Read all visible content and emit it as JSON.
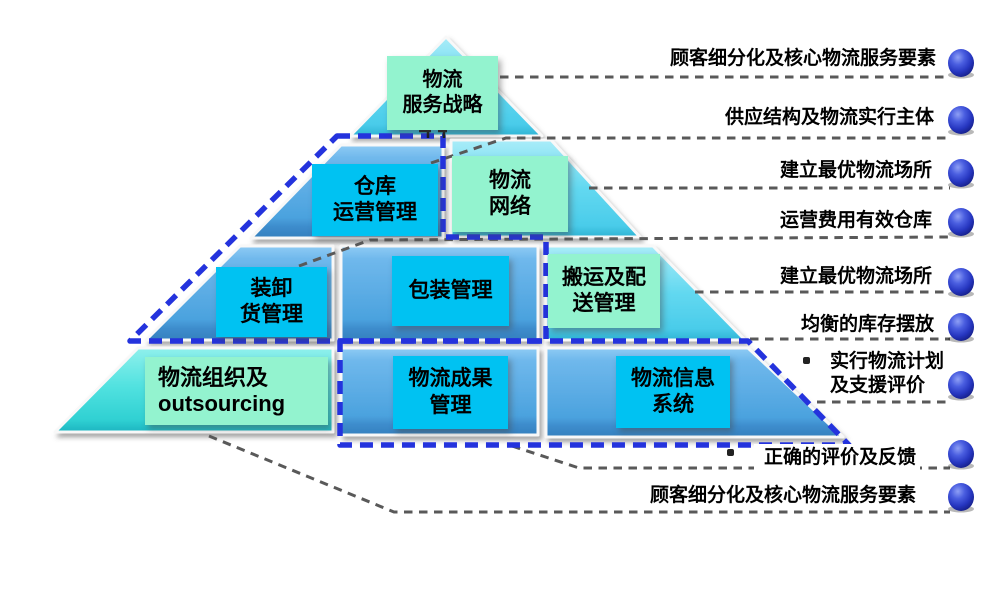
{
  "diagram": {
    "type": "pyramid",
    "subject": "logistics management hierarchy",
    "boxes": [
      {
        "id": "strategy",
        "text": "物流\n服务战略",
        "style": "mint"
      },
      {
        "id": "warehouse-ops",
        "text": "仓库\n运营管理",
        "style": "cyan"
      },
      {
        "id": "network",
        "text": "物流\n网络",
        "style": "mint"
      },
      {
        "id": "loading",
        "text": "装卸\n货管理",
        "style": "cyan"
      },
      {
        "id": "packaging",
        "text": "包装管理",
        "style": "cyan"
      },
      {
        "id": "handling-delivery",
        "text": "搬运及配\n送管理",
        "style": "mint"
      },
      {
        "id": "organization",
        "text": "物流组织及\noutsourcing",
        "style": "mint"
      },
      {
        "id": "results",
        "text": "物流成果\n管理",
        "style": "cyan"
      },
      {
        "id": "information",
        "text": "物流信息\n系统",
        "style": "cyan"
      }
    ],
    "annotations": [
      {
        "id": "a1",
        "text": "顾客细分化及核心物流服务要素",
        "bullet": false
      },
      {
        "id": "a2",
        "text": "供应结构及物流实行主体",
        "bullet": false
      },
      {
        "id": "a3",
        "text": "建立最优物流场所",
        "bullet": false
      },
      {
        "id": "a4",
        "text": "运营费用有效仓库",
        "bullet": false
      },
      {
        "id": "a5",
        "text": "建立最优物流场所",
        "bullet": false
      },
      {
        "id": "a6",
        "text": "均衡的库存摆放",
        "bullet": false
      },
      {
        "id": "a7",
        "text": "实行物流计划\n及支援评价",
        "bullet": true
      },
      {
        "id": "a8",
        "text": "正确的评价及反馈",
        "bullet": true
      },
      {
        "id": "a9",
        "text": "顾客细分化及核心物流服务要素",
        "bullet": false
      }
    ],
    "icons": {
      "annotation_marker": "blue-sphere-icon"
    },
    "colors": {
      "cyan_box": "#00c2f2",
      "mint_box": "#93f3cf",
      "blue_band": "#55abe3",
      "cyan_band": "#5fd7f0",
      "teal_band": "#48dfdf",
      "dashed_group_outline": "#2433dd",
      "connector_line": "#595959",
      "sphere_blue": "#3347cc",
      "text": "#000000"
    }
  }
}
